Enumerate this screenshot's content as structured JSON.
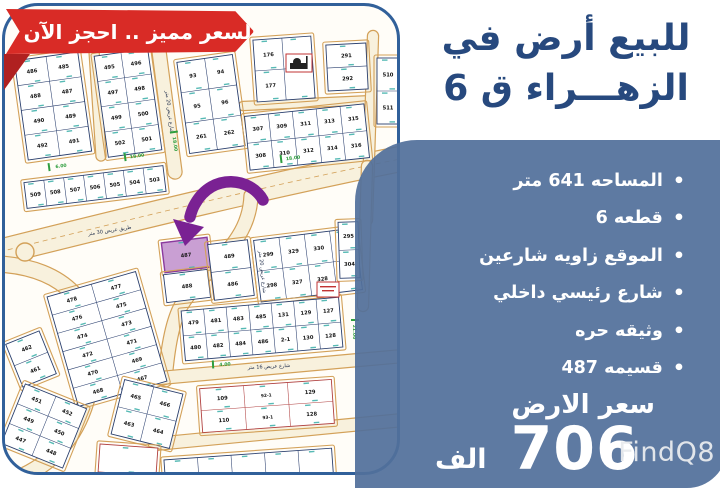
{
  "banner": {
    "label": "السعر مميز .. احجز الآن",
    "color": "#d92b26"
  },
  "title": {
    "line1": "للبيع أرض في",
    "line2": "الزهـــراء ق 6",
    "color": "#27497e"
  },
  "panel": {
    "background": "#52709b",
    "bullets": [
      "المساحه 641 متر",
      "قطعه 6",
      "الموقع زاويه شارعين",
      "شارع رئيسي داخلي",
      "وثيقه حره",
      "قسيمه 487"
    ],
    "price_label": "سعر الارض",
    "price_value": "706",
    "price_unit": "الف"
  },
  "watermark": "FindQ8",
  "map": {
    "highlight_plot": "487",
    "colors": {
      "plot_line": "#2a3f6e",
      "road_edge": "#d3a159",
      "road_fill": "#f8f1dd",
      "tick": "#45b3ad",
      "measure": "#2f9e3f",
      "highlight_fill": "#c99fd3",
      "highlight_stroke": "#8b3a9e",
      "arrow": "#7a2193",
      "special_stroke": "#b04040"
    },
    "blocks": [
      {
        "x": 16,
        "y": 50,
        "w": 64,
        "h": 100,
        "rot": -8,
        "rows": [
          [
            "486",
            "485"
          ],
          [
            "488",
            "487"
          ],
          [
            "490",
            "489"
          ],
          [
            "492",
            "491"
          ]
        ]
      },
      {
        "x": 96,
        "y": 46,
        "w": 54,
        "h": 102,
        "rot": -8,
        "rows": [
          [
            "495",
            "496"
          ],
          [
            "497",
            "498"
          ],
          [
            "499",
            "500"
          ],
          [
            "502",
            "501"
          ]
        ]
      },
      {
        "x": 178,
        "y": 52,
        "w": 56,
        "h": 92,
        "rot": -8,
        "rows": [
          [
            "93",
            "94"
          ],
          [
            "95",
            "96"
          ],
          [
            "261",
            "262"
          ]
        ]
      },
      {
        "x": 20,
        "y": 168,
        "w": 140,
        "h": 26,
        "rot": -7,
        "rows": [
          [
            "509",
            "508",
            "507",
            "506",
            "505",
            "504",
            "503"
          ]
        ]
      },
      {
        "x": 250,
        "y": 32,
        "w": 58,
        "h": 62,
        "rot": -4,
        "rows": [
          [
            "176",
            ""
          ],
          [
            "177",
            ""
          ]
        ]
      },
      {
        "x": 322,
        "y": 38,
        "w": 40,
        "h": 46,
        "rot": -3,
        "rows": [
          [
            "291"
          ],
          [
            "292"
          ]
        ]
      },
      {
        "x": 372,
        "y": 52,
        "w": 22,
        "h": 66,
        "rot": 0,
        "rows": [
          [
            "510"
          ],
          [
            "511"
          ]
        ]
      },
      {
        "x": 242,
        "y": 104,
        "w": 120,
        "h": 54,
        "rot": -6,
        "rows": [
          [
            "307",
            "309",
            "311",
            "313",
            "315"
          ],
          [
            "308",
            "310",
            "312",
            "314",
            "316"
          ]
        ]
      },
      {
        "x": 158,
        "y": 234,
        "w": 46,
        "h": 30,
        "rot": -7,
        "highlight": true,
        "rows": [
          [
            "487"
          ]
        ]
      },
      {
        "x": 160,
        "y": 266,
        "w": 44,
        "h": 28,
        "rot": -7,
        "rows": [
          [
            "488"
          ]
        ]
      },
      {
        "x": 206,
        "y": 236,
        "w": 40,
        "h": 56,
        "rot": -7,
        "rows": [
          [
            "489"
          ],
          [
            "486"
          ]
        ]
      },
      {
        "x": 252,
        "y": 228,
        "w": 102,
        "h": 62,
        "rot": -7,
        "rows": [
          [
            "299",
            "329",
            "330",
            "303"
          ],
          [
            "298",
            "327",
            "328",
            "301"
          ]
        ]
      },
      {
        "x": 56,
        "y": 276,
        "w": 92,
        "h": 114,
        "rot": -16,
        "rows": [
          [
            "478",
            "477"
          ],
          [
            "476",
            "475"
          ],
          [
            "474",
            "473"
          ],
          [
            "472",
            "471"
          ],
          [
            "470",
            "469"
          ],
          [
            "468",
            "467"
          ]
        ]
      },
      {
        "x": 8,
        "y": 330,
        "w": 36,
        "h": 46,
        "rot": -22,
        "rows": [
          [
            "462"
          ],
          [
            "461"
          ]
        ]
      },
      {
        "x": 178,
        "y": 298,
        "w": 158,
        "h": 50,
        "rot": -5,
        "rows": [
          [
            "479",
            "481",
            "483",
            "485",
            "131",
            "129",
            "127"
          ],
          [
            "480",
            "482",
            "484",
            "486",
            "2-1",
            "130",
            "128"
          ]
        ]
      },
      {
        "x": 196,
        "y": 378,
        "w": 132,
        "h": 44,
        "rot": -4,
        "special": true,
        "rows": [
          [
            "109",
            "92-1",
            "129"
          ],
          [
            "110",
            "93-1",
            "128"
          ]
        ]
      },
      {
        "x": 6,
        "y": 388,
        "w": 66,
        "h": 64,
        "rot": 22,
        "rows": [
          [
            "451",
            "452"
          ],
          [
            "449",
            "450"
          ],
          [
            "447",
            "448"
          ]
        ]
      },
      {
        "x": 112,
        "y": 380,
        "w": 60,
        "h": 56,
        "rot": 14,
        "rows": [
          [
            "465",
            "466"
          ],
          [
            "463",
            "464"
          ]
        ]
      },
      {
        "x": 334,
        "y": 216,
        "w": 20,
        "h": 56,
        "rot": -2,
        "rows": [
          [
            "295"
          ],
          [
            "304"
          ]
        ]
      },
      {
        "x": 160,
        "y": 448,
        "w": 168,
        "h": 36,
        "rot": -4,
        "rows": [
          [
            "",
            "",
            "",
            "",
            ""
          ]
        ]
      },
      {
        "x": 94,
        "y": 440,
        "w": 58,
        "h": 28,
        "rot": 4,
        "special": true,
        "rows": [
          [
            ""
          ]
        ]
      }
    ],
    "road_labels": [
      {
        "t": "طريق عريض 30 متر",
        "x": 105,
        "y": 226,
        "r": -9
      },
      {
        "t": "شارع عريض 20 متر",
        "x": 163,
        "y": 106,
        "r": 83
      },
      {
        "t": "شارع عريض 20 متر",
        "x": 256,
        "y": 266,
        "r": 84
      },
      {
        "t": "شارع عريض 16 متر",
        "x": 264,
        "y": 362,
        "r": -3
      }
    ],
    "measurements": [
      {
        "t": "18.00",
        "x": 170,
        "y": 134,
        "r": 82
      },
      {
        "t": "18.00",
        "x": 284,
        "y": 152,
        "r": -7
      },
      {
        "t": "6.00",
        "x": 52,
        "y": 160,
        "r": -8
      },
      {
        "t": "21.00",
        "x": 350,
        "y": 322,
        "r": 90
      },
      {
        "t": "4.00",
        "x": 216,
        "y": 358,
        "r": -3
      },
      {
        "t": "18.00",
        "x": 128,
        "y": 150,
        "r": -8
      }
    ]
  }
}
